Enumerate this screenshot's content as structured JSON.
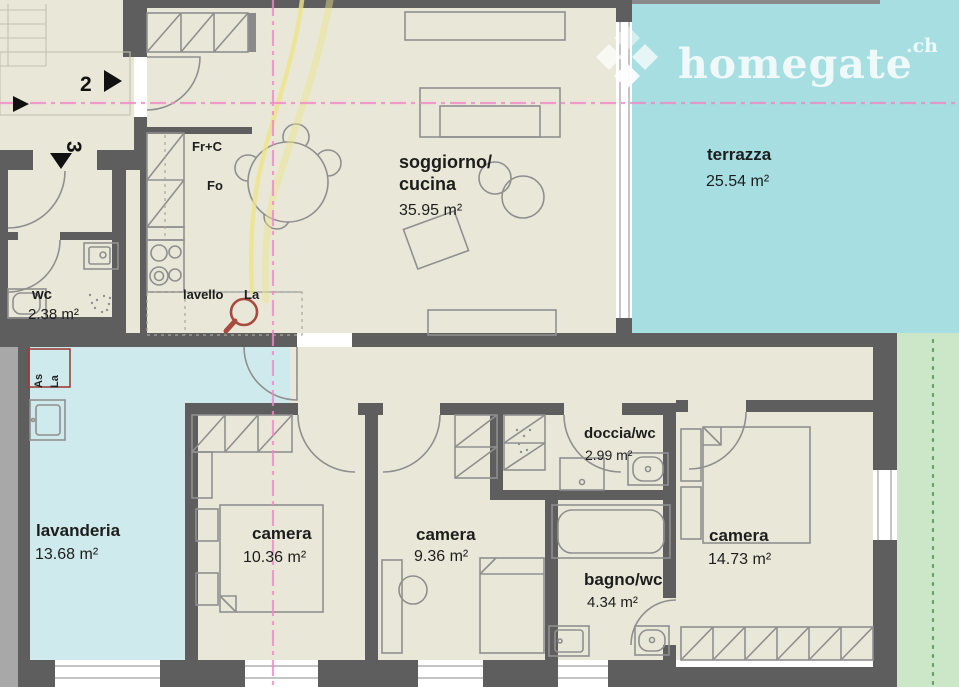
{
  "logo": {
    "brand": "homegate",
    "tld": ".ch"
  },
  "rooms": {
    "terrazza": {
      "name": "terrazza",
      "area": "25.54 m²"
    },
    "soggiorno": {
      "line1": "soggiorno/",
      "line2": "cucina",
      "area": "35.95 m²"
    },
    "wc": {
      "name": "wc",
      "area": "2.38 m²"
    },
    "lavanderia": {
      "name": "lavanderia",
      "area": "13.68 m²"
    },
    "camera1": {
      "name": "camera",
      "area": "10.36 m²"
    },
    "camera2": {
      "name": "camera",
      "area": "9.36 m²"
    },
    "doccia": {
      "name": "doccia/wc",
      "area": "2.99 m²"
    },
    "bagno": {
      "name": "bagno/wc",
      "area": "4.34 m²"
    },
    "camera3": {
      "name": "camera",
      "area": "14.73 m²"
    }
  },
  "kitchen": {
    "fridge": "Fr+C",
    "oven": "Fo",
    "sink": "lavello",
    "sink_abbr": "La"
  },
  "laundry": {
    "dryer_abbr": "As",
    "washer_abbr": "La"
  },
  "markers": {
    "unit2": "2",
    "unit3": "3"
  },
  "colors": {
    "wall": "#5e5e5e",
    "floor": "#e9e8d8",
    "terrace": "#a7dee1",
    "laundry": "#cfeaec",
    "garden": "#cbe7c8",
    "section_line": "#ef87c5",
    "highlight": "#ece48a",
    "fixture_red": "#a94a40"
  }
}
